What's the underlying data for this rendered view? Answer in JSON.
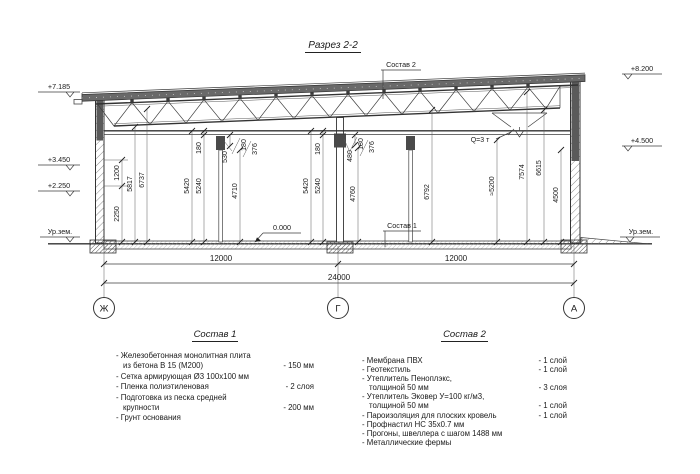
{
  "title": "Разрез 2-2",
  "callouts": {
    "sostav2": "Состав 2",
    "sostav1": "Состав 1",
    "crane_capacity": "Q=3 т",
    "zero_mark": "0.000"
  },
  "elevations": {
    "left_top": "+7.185",
    "left_mid": "+3.450",
    "left_low": "+2.250",
    "left_ground": "Ур.зем.",
    "right_top": "+8.200",
    "right_mid": "+4.500",
    "right_ground": "Ур.зем."
  },
  "axes": {
    "left": "Ж",
    "middle": "Г",
    "right": "А"
  },
  "dims": {
    "h2250": "2250",
    "h1200": "1200",
    "h5817": "5817",
    "h6737": "6737",
    "h180a": "180",
    "h5420a": "5420",
    "h5240a": "5240",
    "h530": "530",
    "h180b": "180",
    "h376a": "376",
    "h4710": "4710",
    "h5420b": "5420",
    "h5240b": "5240",
    "h180c": "180",
    "h480": "480",
    "h180d": "180",
    "h376b": "376",
    "h4760": "4760",
    "h6792": "6792",
    "h5200": "≈5200",
    "h7574": "7574",
    "h6615": "6615",
    "h4500": "4500",
    "w_left": "12000",
    "w_right": "12000",
    "w_total": "24000"
  },
  "legend1": {
    "heading": "Состав 1",
    "rows": [
      {
        "text": "- Железобетонная  монолитная плита",
        "value": ""
      },
      {
        "text": "из бетона В 15 (М200)",
        "value": "- 150 мм"
      },
      {
        "text": "- Сетка армирующая Ø3 100x100 мм",
        "value": ""
      },
      {
        "text": "- Пленка полиэтиленовая",
        "value": "-  2 слоя"
      },
      {
        "text": "- Подготовка из песка средней",
        "value": ""
      },
      {
        "text": "крупности",
        "value": "- 200 мм"
      },
      {
        "text": "- Грунт основания",
        "value": ""
      }
    ]
  },
  "legend2": {
    "heading": "Состав 2",
    "rows": [
      {
        "text": "- Мембрана ПВХ",
        "value": "- 1 слой"
      },
      {
        "text": "- Геотекстиль",
        "value": "- 1 слой"
      },
      {
        "text": "- Утеплитель Пеноплэкс,",
        "value": ""
      },
      {
        "text": "толщиной 50 мм",
        "value": "- 3 слоя"
      },
      {
        "text": "- Утеплитель Эковер У=100 кг/м3,",
        "value": ""
      },
      {
        "text": "толщиной 50 мм",
        "value": "- 1 слой"
      },
      {
        "text": "- Пароизоляция для плоских кровель",
        "value": "- 1 слой"
      },
      {
        "text": "- Профнастил НС 35х0.7 мм",
        "value": ""
      },
      {
        "text": "- Прогоны, швеллера с шагом 1488 мм",
        "value": ""
      },
      {
        "text": "- Металлические фермы",
        "value": ""
      }
    ]
  }
}
